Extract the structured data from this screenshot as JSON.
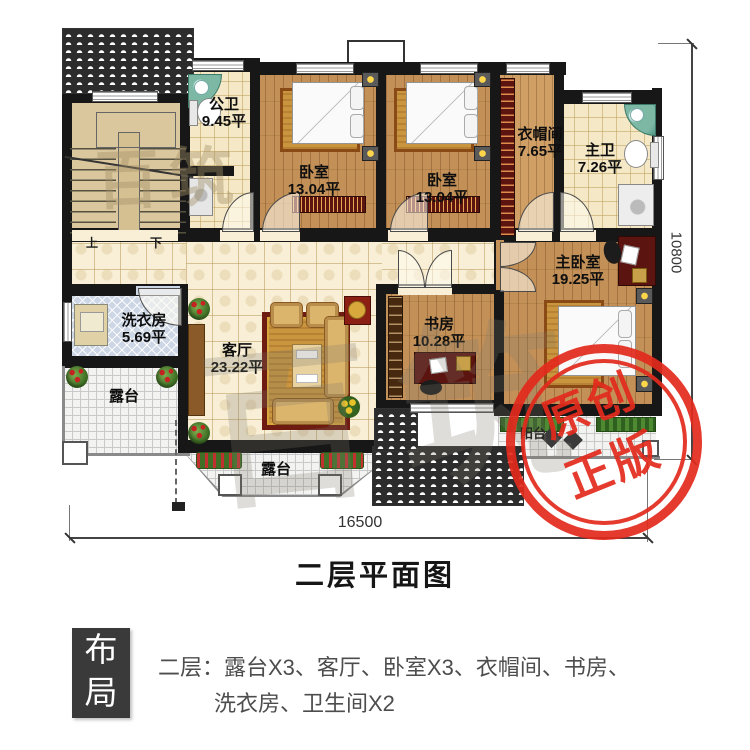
{
  "plan": {
    "title": "二层平面图",
    "watermark": "百筑",
    "rooms": [
      {
        "name": "公卫",
        "area": "9.45平"
      },
      {
        "name": "卧室",
        "area": "13.04平"
      },
      {
        "name": "卧室",
        "area": "13.04平"
      },
      {
        "name": "衣帽间",
        "area": "7.65平"
      },
      {
        "name": "主卫",
        "area": "7.26平"
      },
      {
        "name": "主卧室",
        "area": "19.25平"
      },
      {
        "name": "书房",
        "area": "10.28平"
      },
      {
        "name": "客厅",
        "area": "23.22平"
      },
      {
        "name": "洗衣房",
        "area": "5.69平"
      },
      {
        "name": "露台",
        "area": ""
      },
      {
        "name": "露台",
        "area": ""
      },
      {
        "name": "阳台",
        "area": ""
      }
    ],
    "stairs": {
      "up": "上",
      "down": "下"
    },
    "dims": {
      "width": "16500",
      "height": "10800"
    },
    "stamp": {
      "line1": "原创",
      "line2": "正版",
      "color": "#e32a1d"
    }
  },
  "layout": {
    "box_label": "布局",
    "line1": "二层：露台X3、客厅、卧室X3、衣帽间、书房、",
    "line2": "洗衣房、卫生间X2"
  }
}
